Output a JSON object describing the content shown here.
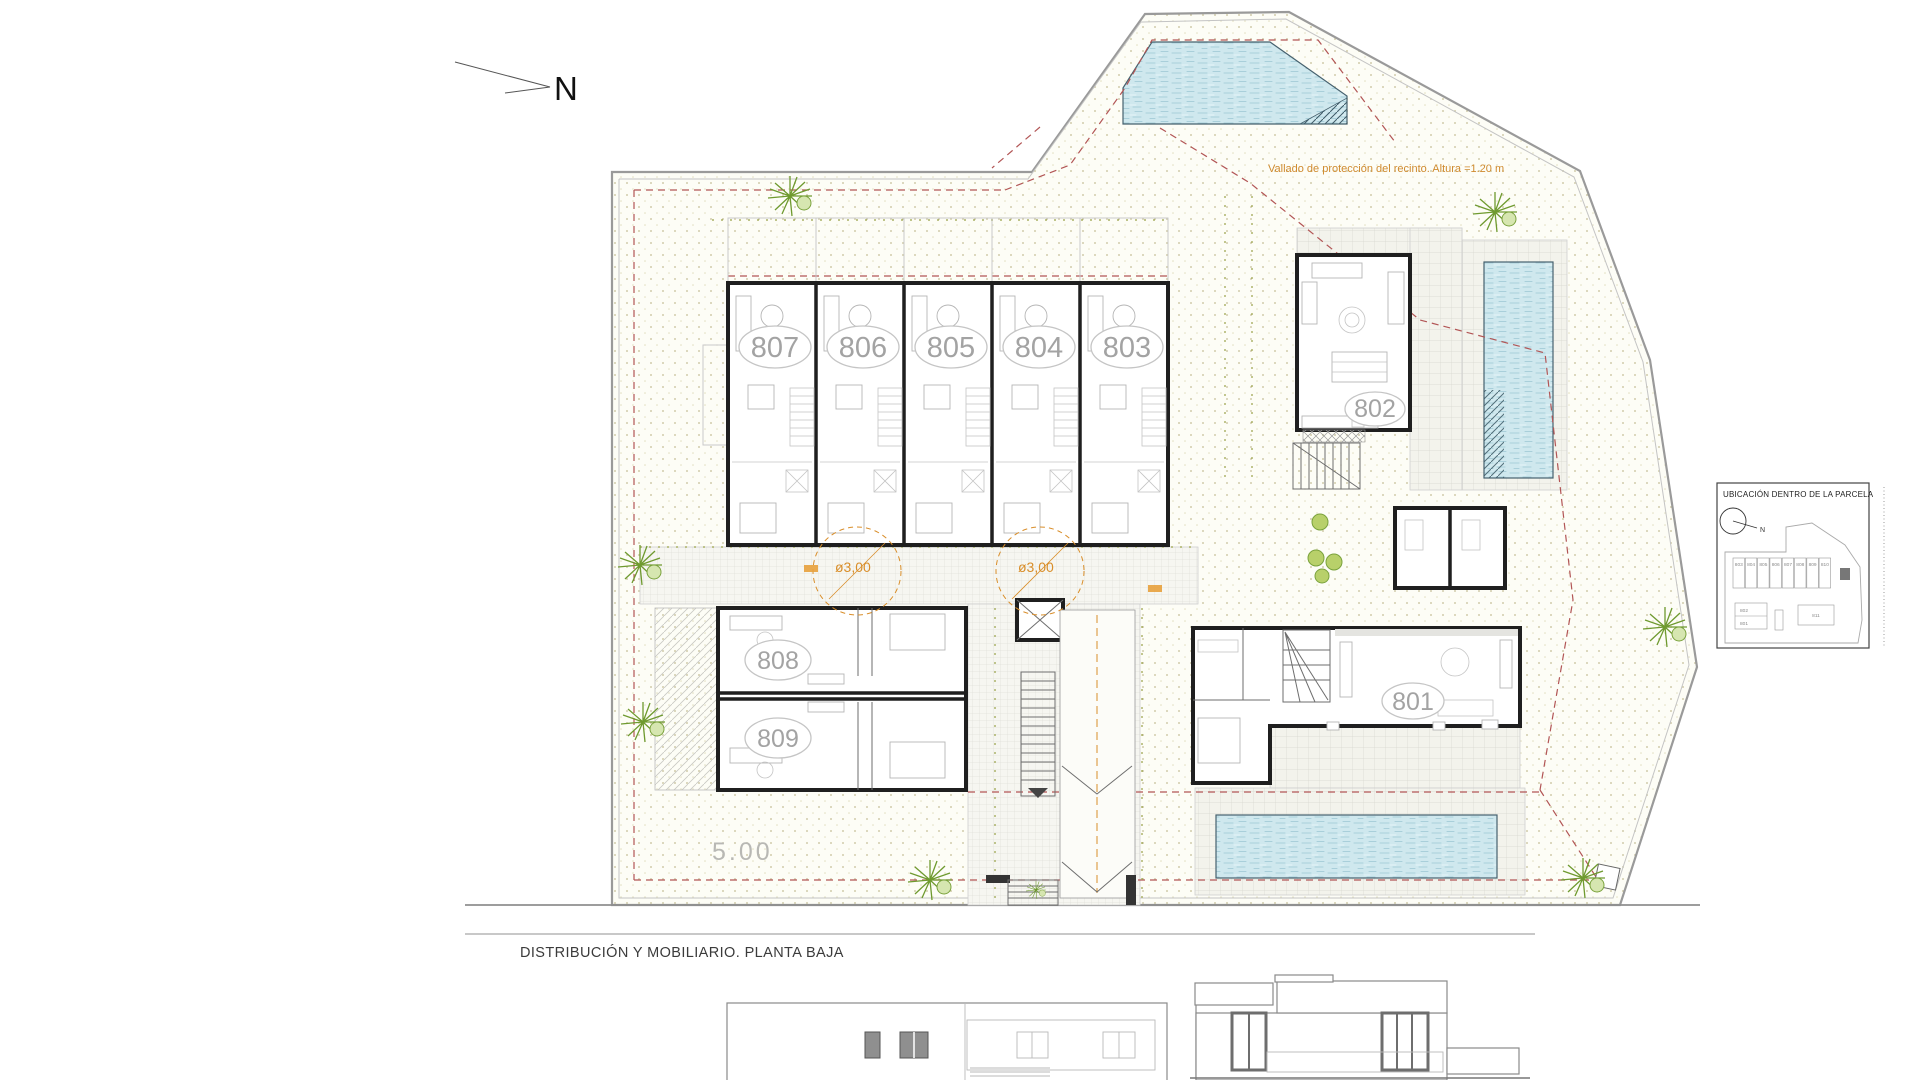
{
  "north": {
    "label": "N"
  },
  "plan": {
    "fence_note": "Vallado de protección del recinto. Altura =1.20 m",
    "turning_circle_labels": [
      "ø3,00",
      "ø3,00"
    ],
    "setback_label": "5.00",
    "townhouses": [
      {
        "label": "807"
      },
      {
        "label": "806"
      },
      {
        "label": "805"
      },
      {
        "label": "804"
      },
      {
        "label": "803"
      }
    ],
    "villas": {
      "v802": {
        "label": "802"
      },
      "v801": {
        "label": "801"
      },
      "v808": {
        "label": "808"
      },
      "v809": {
        "label": "809"
      }
    }
  },
  "footer": {
    "title": "DISTRIBUCIÓN Y MOBILIARIO. PLANTA BAJA"
  },
  "inset": {
    "title": "UBICACIÓN DENTRO DE LA PARCELA",
    "north_label": "N",
    "row_units": [
      "803",
      "804",
      "805",
      "806",
      "807",
      "808",
      "809",
      "810"
    ],
    "left_units": [
      "802",
      "801"
    ],
    "right_unit": "811"
  },
  "colors": {
    "water": "#cfe8ee",
    "fence_red": "#b25555",
    "accent_orange": "#d98e2a",
    "vegetation_green": "#7aa23c",
    "wall": "#1f1f1f"
  }
}
